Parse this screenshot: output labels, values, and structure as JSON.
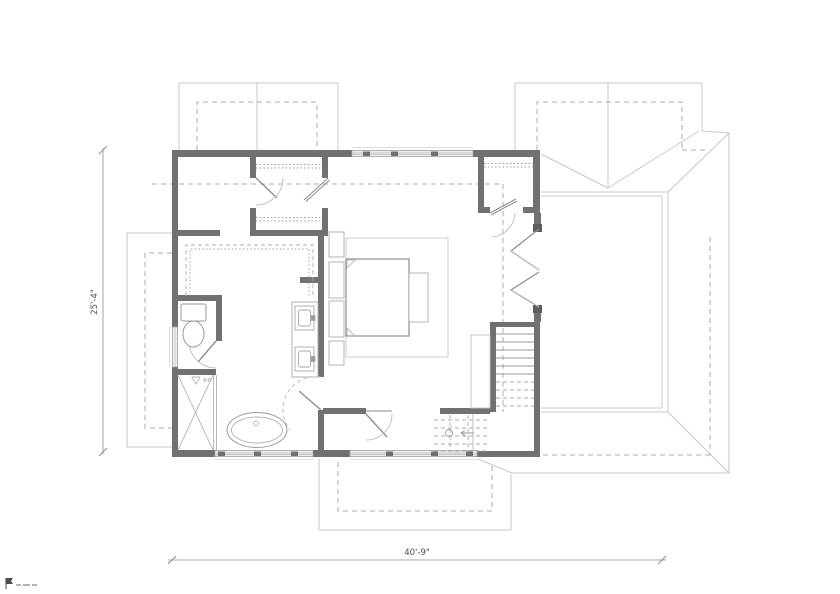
{
  "drawing": {
    "type": "architectural-floor-plan",
    "dimensions": {
      "left": "25'-4\"",
      "bottom": "40'-9\""
    },
    "colors": {
      "background": "#ffffff",
      "walls": "#717171",
      "fixture_lines": "#a8a8a8",
      "roof_lines": "#c8c8c8",
      "dashed_lines": "#ababab",
      "dimension_text": "#4e4e4e"
    },
    "elements": [
      "exterior-walls",
      "interior-walls",
      "windows",
      "doors",
      "bifold-doors",
      "stairs",
      "bed",
      "nightstands",
      "bench",
      "rug",
      "walk-in-closet-shelving",
      "closet-shelving",
      "double-vanity",
      "toilet",
      "freestanding-tub",
      "shower",
      "roof-outline",
      "dormers",
      "dimension-lines",
      "watermark-logo"
    ]
  }
}
